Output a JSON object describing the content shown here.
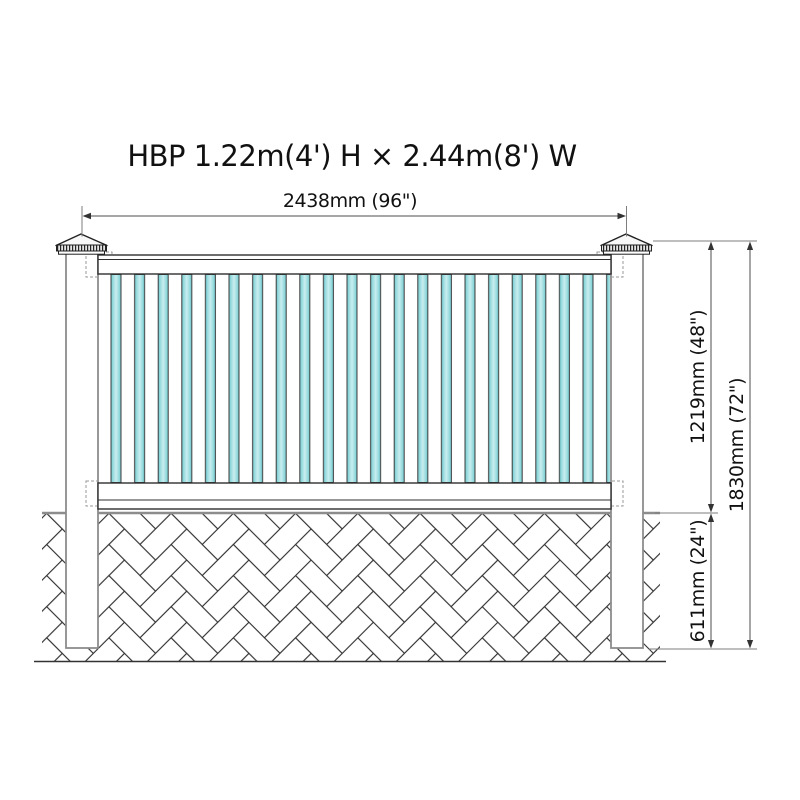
{
  "title": "HBP 1.22m(4') H × 2.44m(8') W",
  "dimensions": {
    "overall_width": "2438mm (96\")",
    "panel_height": "1219mm (48\")",
    "overall_height": "1830mm (72\")",
    "below_ground_depth": "611mm (24\")"
  },
  "colors": {
    "picket_fill": "#a9dfe2",
    "picket_highlight": "#c9edef",
    "picket_shadow": "#6fc8ce",
    "outline": "#2f2f2f",
    "post_outline": "#8c8c8c",
    "ground_line": "#8c8c8c",
    "text": "#111111"
  }
}
